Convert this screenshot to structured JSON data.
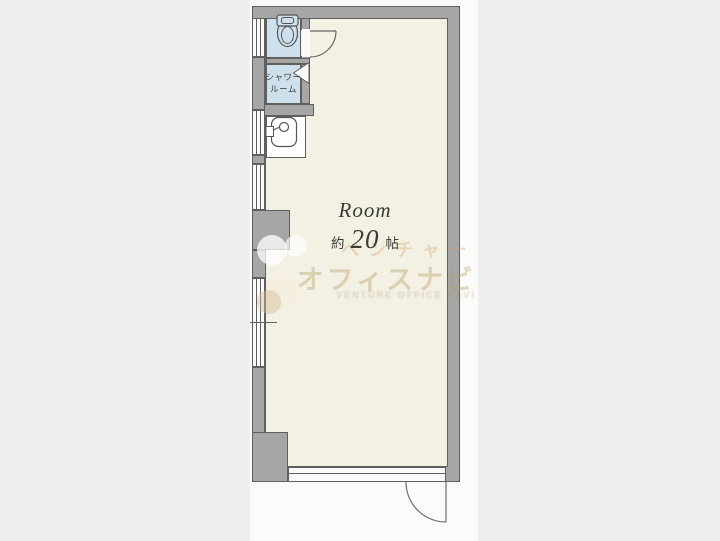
{
  "room": {
    "name": "Room",
    "size_prefix": "約",
    "size_value": "20",
    "size_unit": "帖"
  },
  "labels": {
    "shower_line1": "シャワー",
    "shower_line2": "ルーム"
  },
  "watermark": {
    "line1": "ベンチャー",
    "line2": "オフィスナビ",
    "smallprint": "VENTURE OFFICE NAVI"
  },
  "colors": {
    "page": "#efefef",
    "canvas": "#fbfbf9",
    "wall": "#a6a6a6",
    "wall_outline": "#5f5f5f",
    "floor": "#f3f0e4",
    "wet_room": "#cfe0ed",
    "white_room": "#ffffff",
    "line": "#666666",
    "label": "#3b3b35"
  }
}
